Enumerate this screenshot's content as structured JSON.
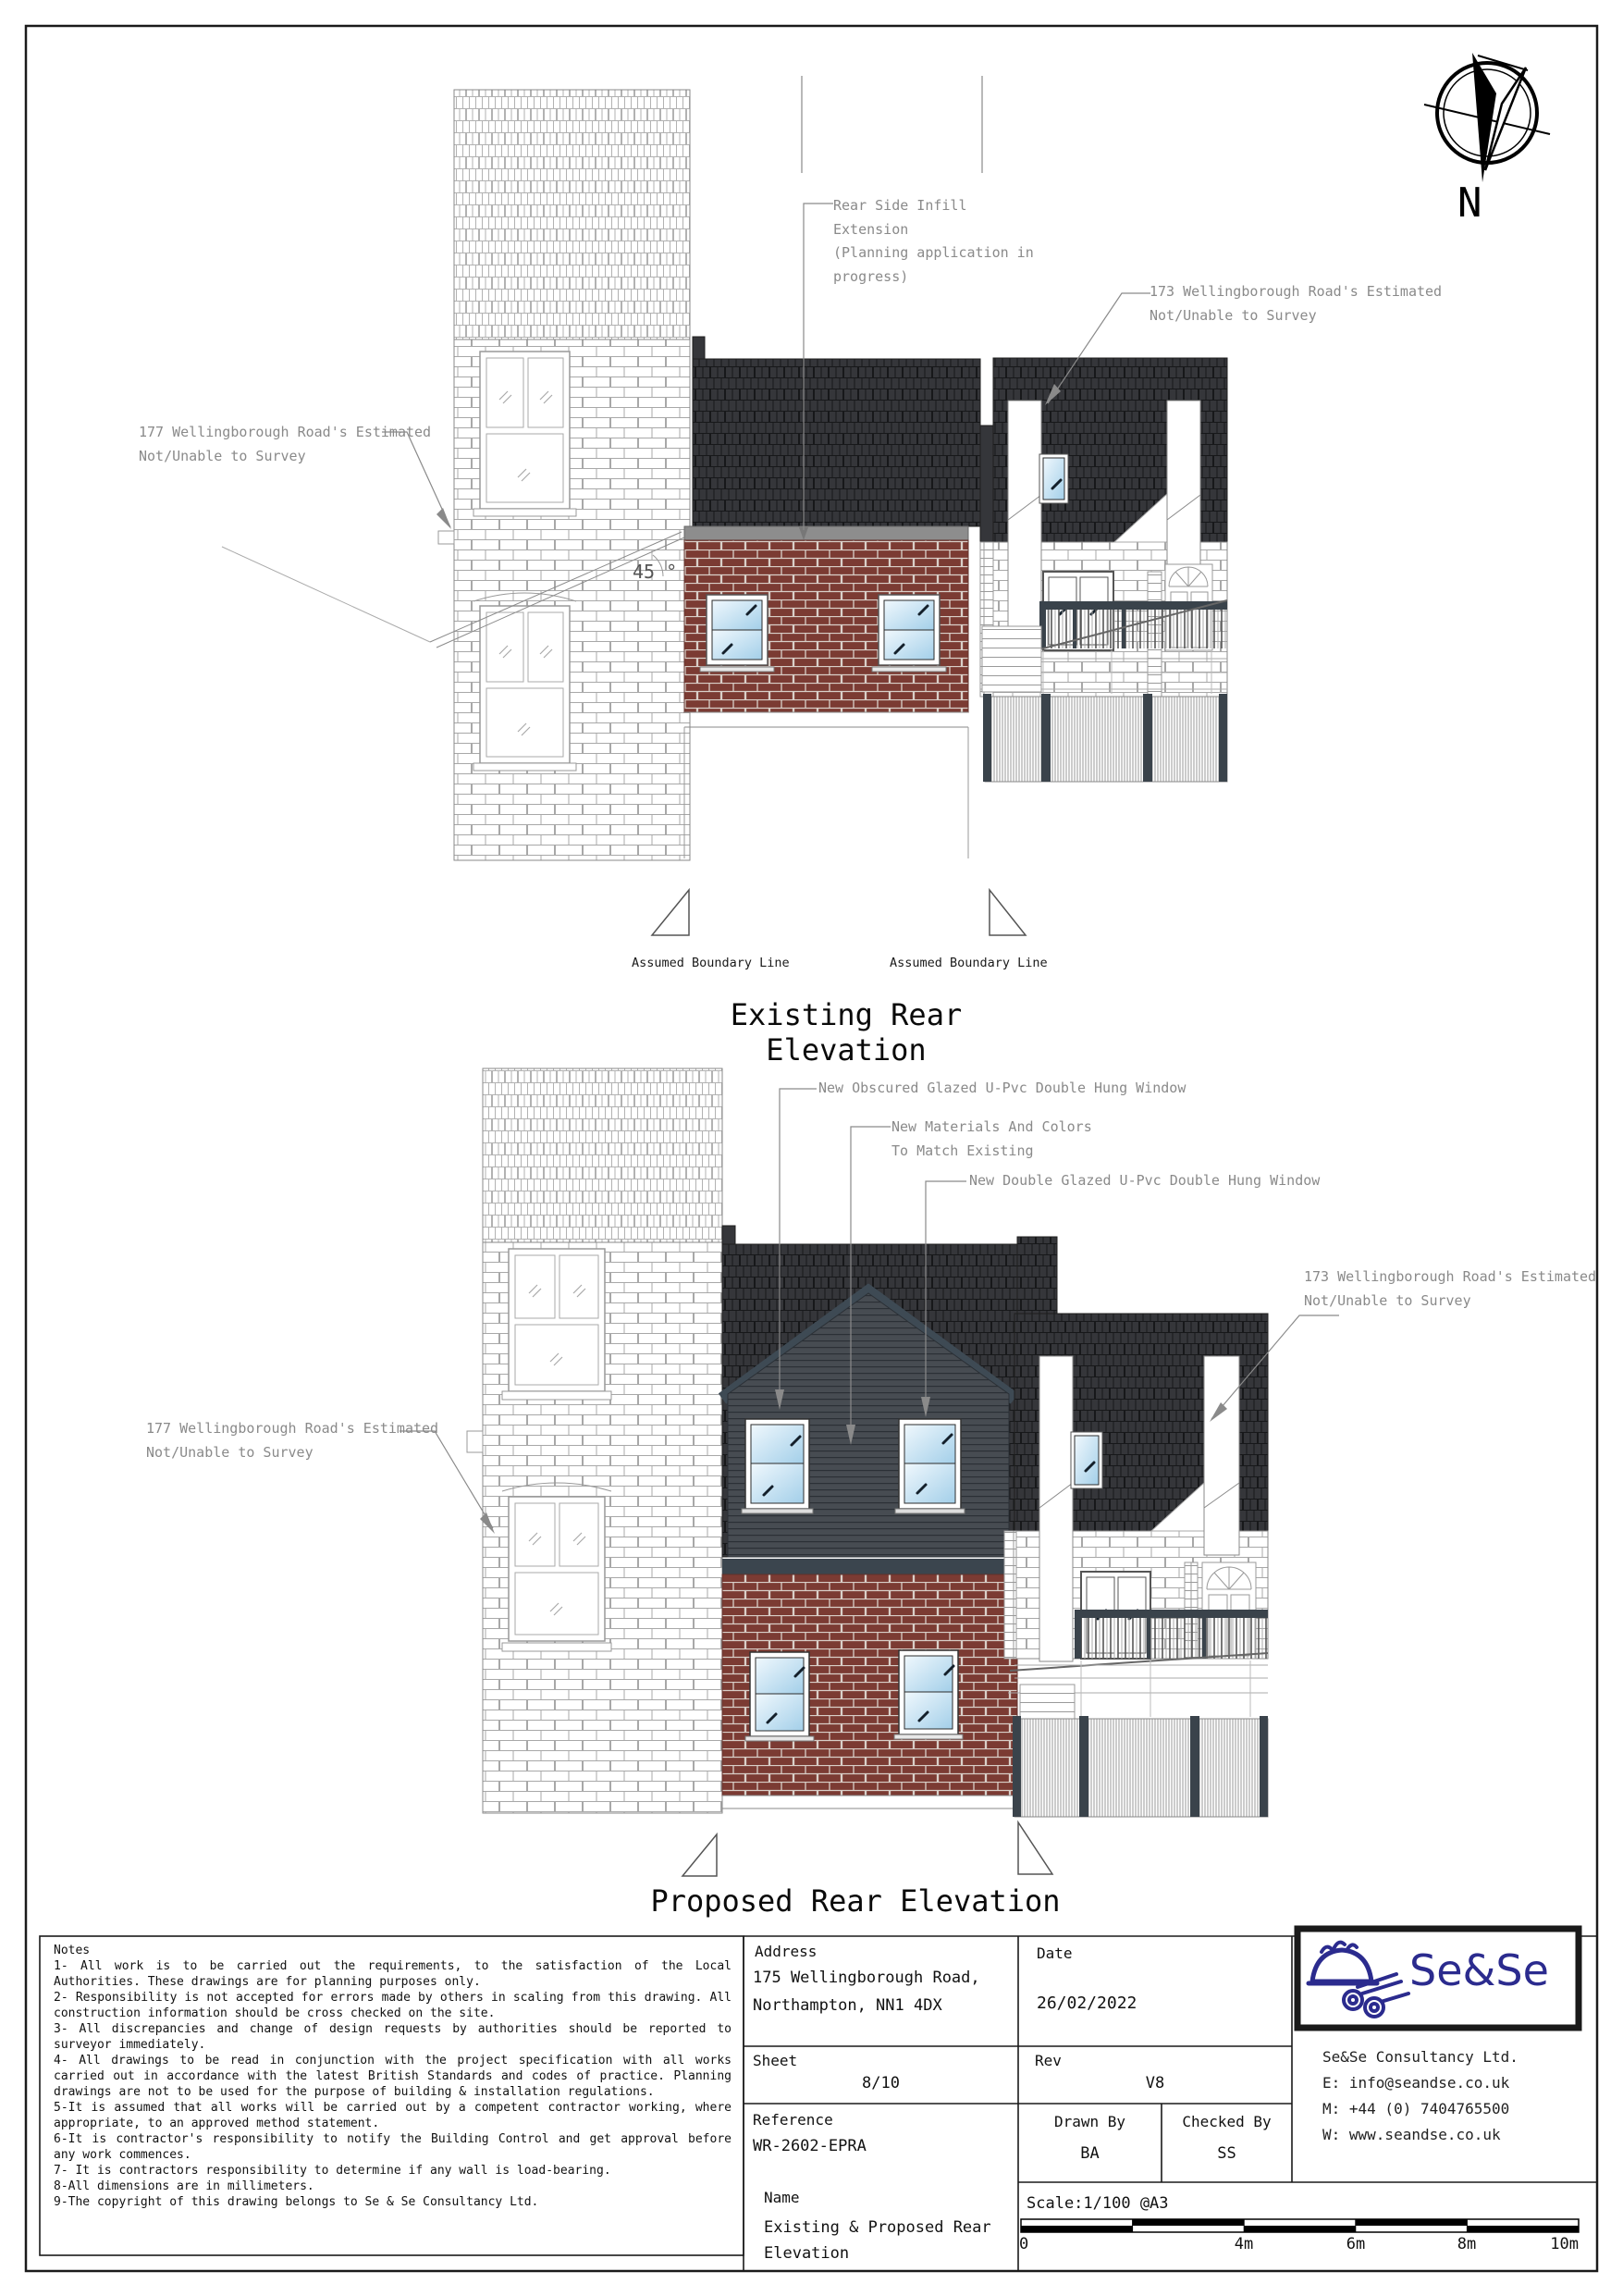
{
  "compass": {
    "north_label": "N"
  },
  "existing": {
    "title": "Existing Rear Elevation",
    "annotations": {
      "infill": "Rear Side Infill Extension\n(Planning application in\nprogress)",
      "left_neighbour": "177 Wellingborough Road's Estimated\nNot/Unable to Survey",
      "right_neighbour": "173 Wellingborough Road's Estimated\nNot/Unable to Survey",
      "angle": "45 °",
      "boundary_left": "Assumed Boundary Line",
      "boundary_right": "Assumed Boundary Line"
    }
  },
  "proposed": {
    "title": "Proposed Rear Elevation",
    "annotations": {
      "window_obscured": "New Obscured Glazed U-Pvc Double Hung Window",
      "materials": "New Materials And Colors\nTo Match Existing",
      "window_glazed": "New Double Glazed U-Pvc Double Hung Window",
      "left_neighbour": "177 Wellingborough Road's Estimated\nNot/Unable to Survey",
      "right_neighbour": "173 Wellingborough Road's Estimated\nNot/Unable to Survey"
    }
  },
  "title_block": {
    "notes": {
      "heading": "Notes",
      "items": [
        "1- All work is to be carried out the requirements, to the satisfaction of the Local Authorities. These drawings are for planning purposes only.",
        "2- Responsibility is not accepted for errors made by others in scaling from this drawing. All construction information should be cross checked on the site.",
        "3- All discrepancies and change of design requests by authorities should be reported to surveyor immediately.",
        "4- All drawings to be read in conjunction with the project specification with all works carried out in accordance with the latest British Standards and codes of practice. Planning drawings are not to be used for the purpose of building & installation regulations.",
        "5-It is assumed that all works will be carried out by a competent contractor working, where appropriate, to an approved method statement.",
        "6-It is contractor's responsibility to notify the Building Control and get approval before any work commences.",
        "7- It is contractors responsibility to determine if any wall is load-bearing.",
        "8-All dimensions are in millimeters.",
        "9-The copyright of this drawing belongs to Se & Se Consultancy Ltd."
      ]
    },
    "address": {
      "label": "Address",
      "line1": "175 Wellingborough Road,",
      "line2": "Northampton, NN1 4DX"
    },
    "date": {
      "label": "Date",
      "value": "26/02/2022"
    },
    "sheet": {
      "label": "Sheet",
      "value": "8/10"
    },
    "rev": {
      "label": "Rev",
      "value": "V8"
    },
    "reference": {
      "label": "Reference",
      "value": "WR-2602-EPRA"
    },
    "drawn_by": {
      "label": "Drawn By",
      "value": "BA"
    },
    "checked_by": {
      "label": "Checked By",
      "value": "SS"
    },
    "name": {
      "label": "Name",
      "value": "Existing & Proposed Rear\nElevation"
    },
    "scale": {
      "label": "Scale:1/100 @A3",
      "ticks": [
        "0",
        "4m",
        "6m",
        "8m",
        "10m"
      ]
    },
    "company": {
      "logo_text": "Se&Se",
      "name": "Se&Se Consultancy Ltd.",
      "email": "E: info@seandse.co.uk",
      "mobile": "M: +44 (0) 7404765500",
      "web": "W: www.seandse.co.uk"
    }
  },
  "colors": {
    "brick_red": "#7b3b33",
    "shingle_dark": "#35363a",
    "cladding": "#474c52",
    "fascia_grey": "#8d8d8d",
    "accent_navy": "#2b2b8e",
    "glazing_blue": "#a3cfe9"
  }
}
